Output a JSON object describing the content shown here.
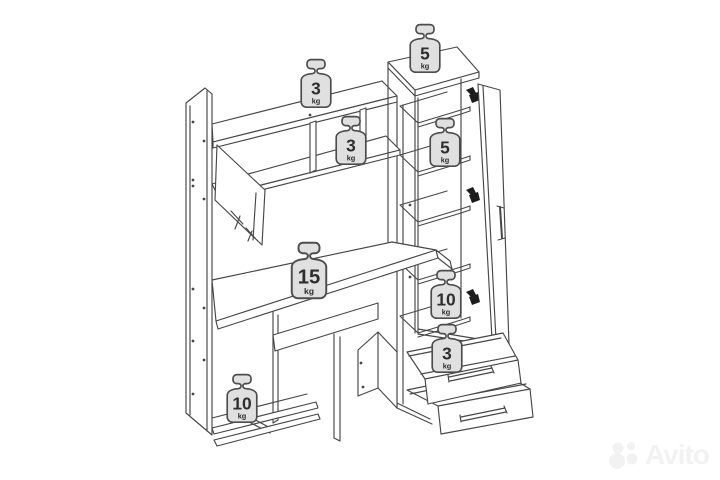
{
  "diagram": {
    "type": "furniture-load-diagram",
    "description": "Computer desk with hutch, wardrobe column and pull-out drawers; maximum load per surface",
    "line_color": "#474747",
    "badge": {
      "fill": "#e0e0e0",
      "stroke": "#4d4d4d",
      "text_color": "#2e2e2e"
    },
    "weights": [
      {
        "location": "hutch-top-shelf",
        "value": "3",
        "unit": "kg"
      },
      {
        "location": "wardrobe-top",
        "value": "5",
        "unit": "kg"
      },
      {
        "location": "hutch-middle-shelf",
        "value": "3",
        "unit": "kg"
      },
      {
        "location": "wardrobe-upper-shelf",
        "value": "5",
        "unit": "kg"
      },
      {
        "location": "desk-top",
        "value": "15",
        "unit": "kg"
      },
      {
        "location": "wardrobe-lower-shelf",
        "value": "10",
        "unit": "kg"
      },
      {
        "location": "top-drawer",
        "value": "3",
        "unit": "kg"
      },
      {
        "location": "bottom-left-shelf",
        "value": "10",
        "unit": "kg"
      }
    ]
  },
  "watermark": {
    "text": "Avito",
    "color": "#f2f2f2"
  }
}
